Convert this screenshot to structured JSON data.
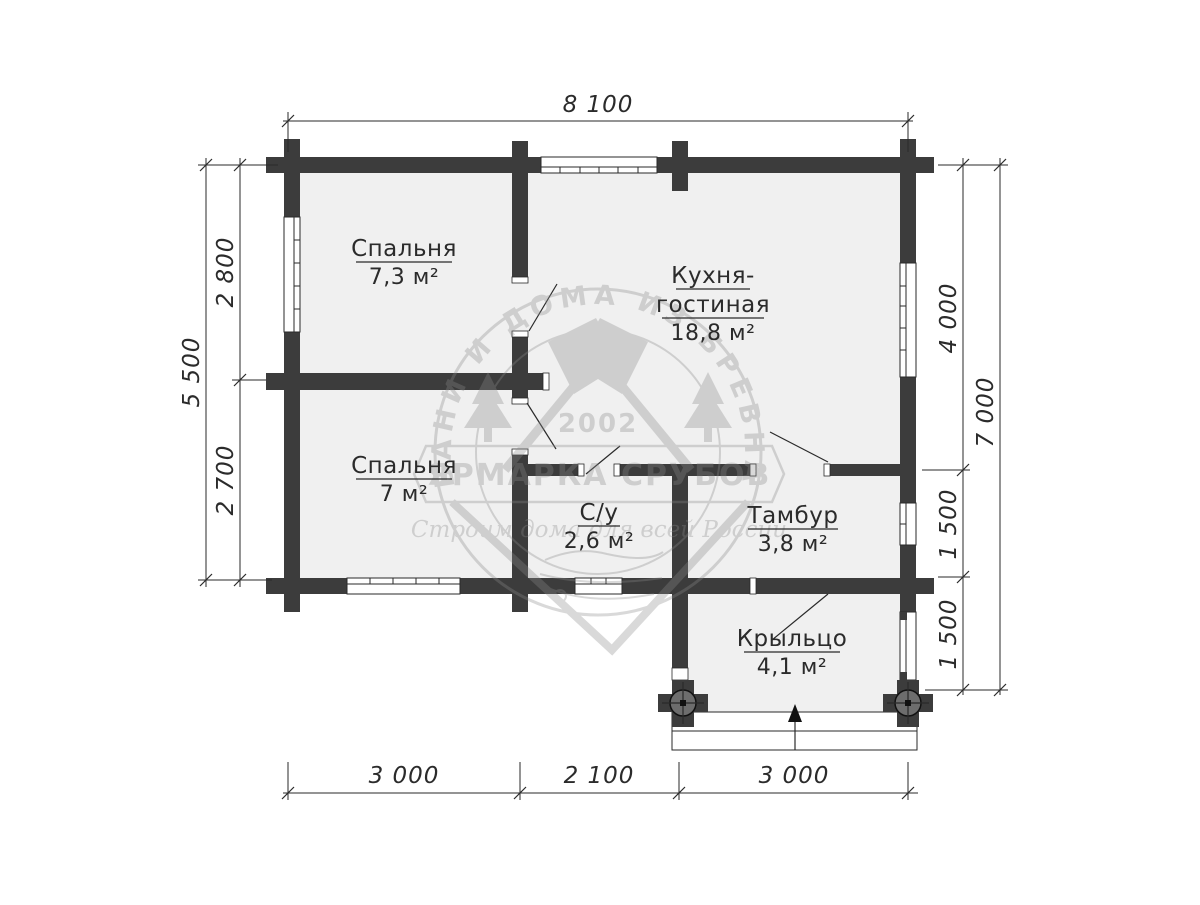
{
  "plan": {
    "rooms": [
      {
        "name": "Спальня",
        "area": "7,3 м²"
      },
      {
        "name": "Кухня-",
        "name2": "гостиная",
        "area": "18,8 м²"
      },
      {
        "name": "Спальня",
        "area": "7 м²"
      },
      {
        "name": "С/у",
        "area": "2,6 м²"
      },
      {
        "name": "Тамбур",
        "area": "3,8 м²"
      },
      {
        "name": "Крыльцо",
        "area": "4,1 м²"
      }
    ],
    "dimensions": {
      "top": "8 100",
      "left_upper": "2 800",
      "left_lower": "2 700",
      "left_total": "5 500",
      "right_upper": "4 000",
      "right_mid": "1 500",
      "right_lower": "1 500",
      "right_total": "7 000",
      "bottom_left": "3 000",
      "bottom_center": "2 100",
      "bottom_right": "3 000"
    },
    "watermark": {
      "arc_text": "БАНИ И ДОМА ИЗ БРЕВНА",
      "year": "2002",
      "title": "ЯРМАРКА СРУБОВ",
      "subtitle": "Строим дома для всей России"
    },
    "colors": {
      "wall": "#3c3c3c",
      "room_fill": "#f0f0f0",
      "line": "#2a2a2a",
      "watermark": "#8a8a8a",
      "background": "#ffffff"
    }
  }
}
